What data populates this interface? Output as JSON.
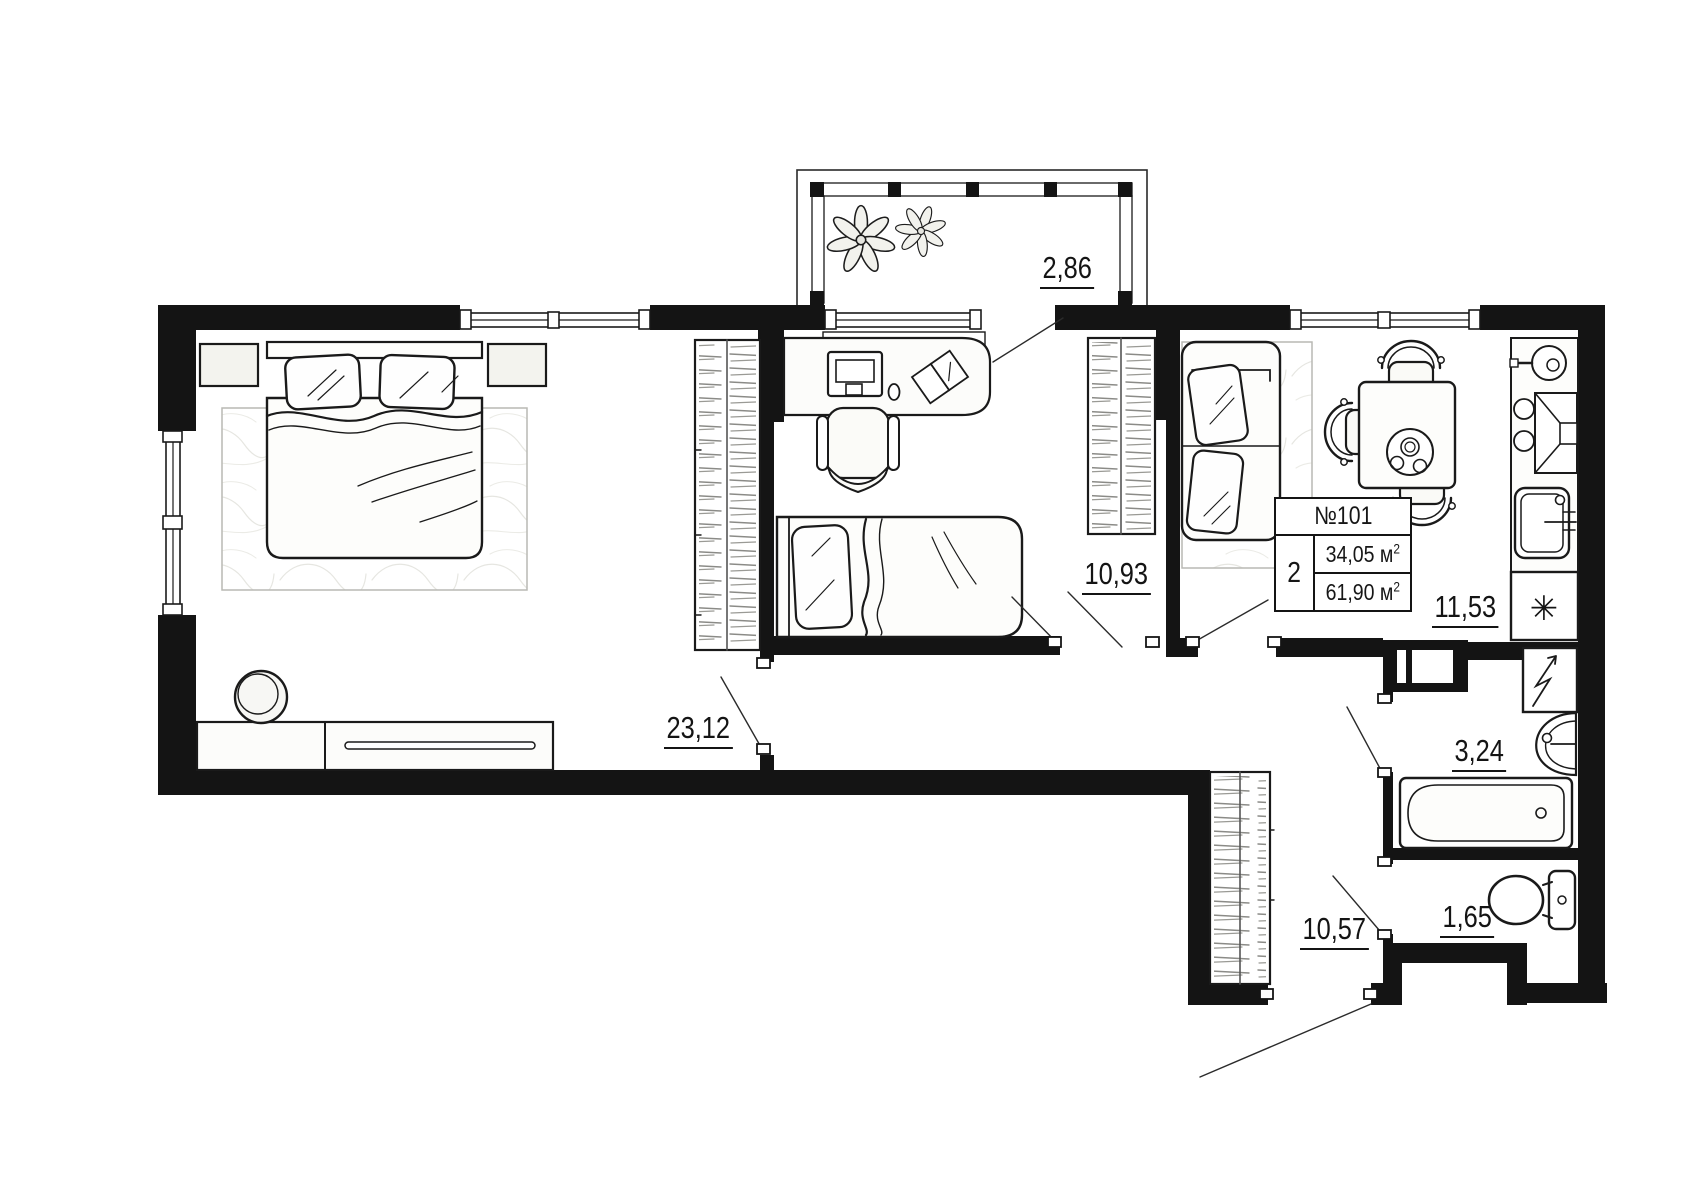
{
  "plan": {
    "info_box": {
      "unit_number": "№101",
      "rooms": "2",
      "living_area": {
        "value": "34,05",
        "unit": "м",
        "sup": "2"
      },
      "total_area": {
        "value": "61,90",
        "unit": "м",
        "sup": "2"
      }
    },
    "areas": {
      "balcony": "2,86",
      "living_room": "23,12",
      "child_room": "10,93",
      "kitchen": "11,53",
      "bathroom": "3,24",
      "toilet": "1,65",
      "hallway": "10,57"
    },
    "symbols": {
      "fridge": "✳"
    }
  }
}
